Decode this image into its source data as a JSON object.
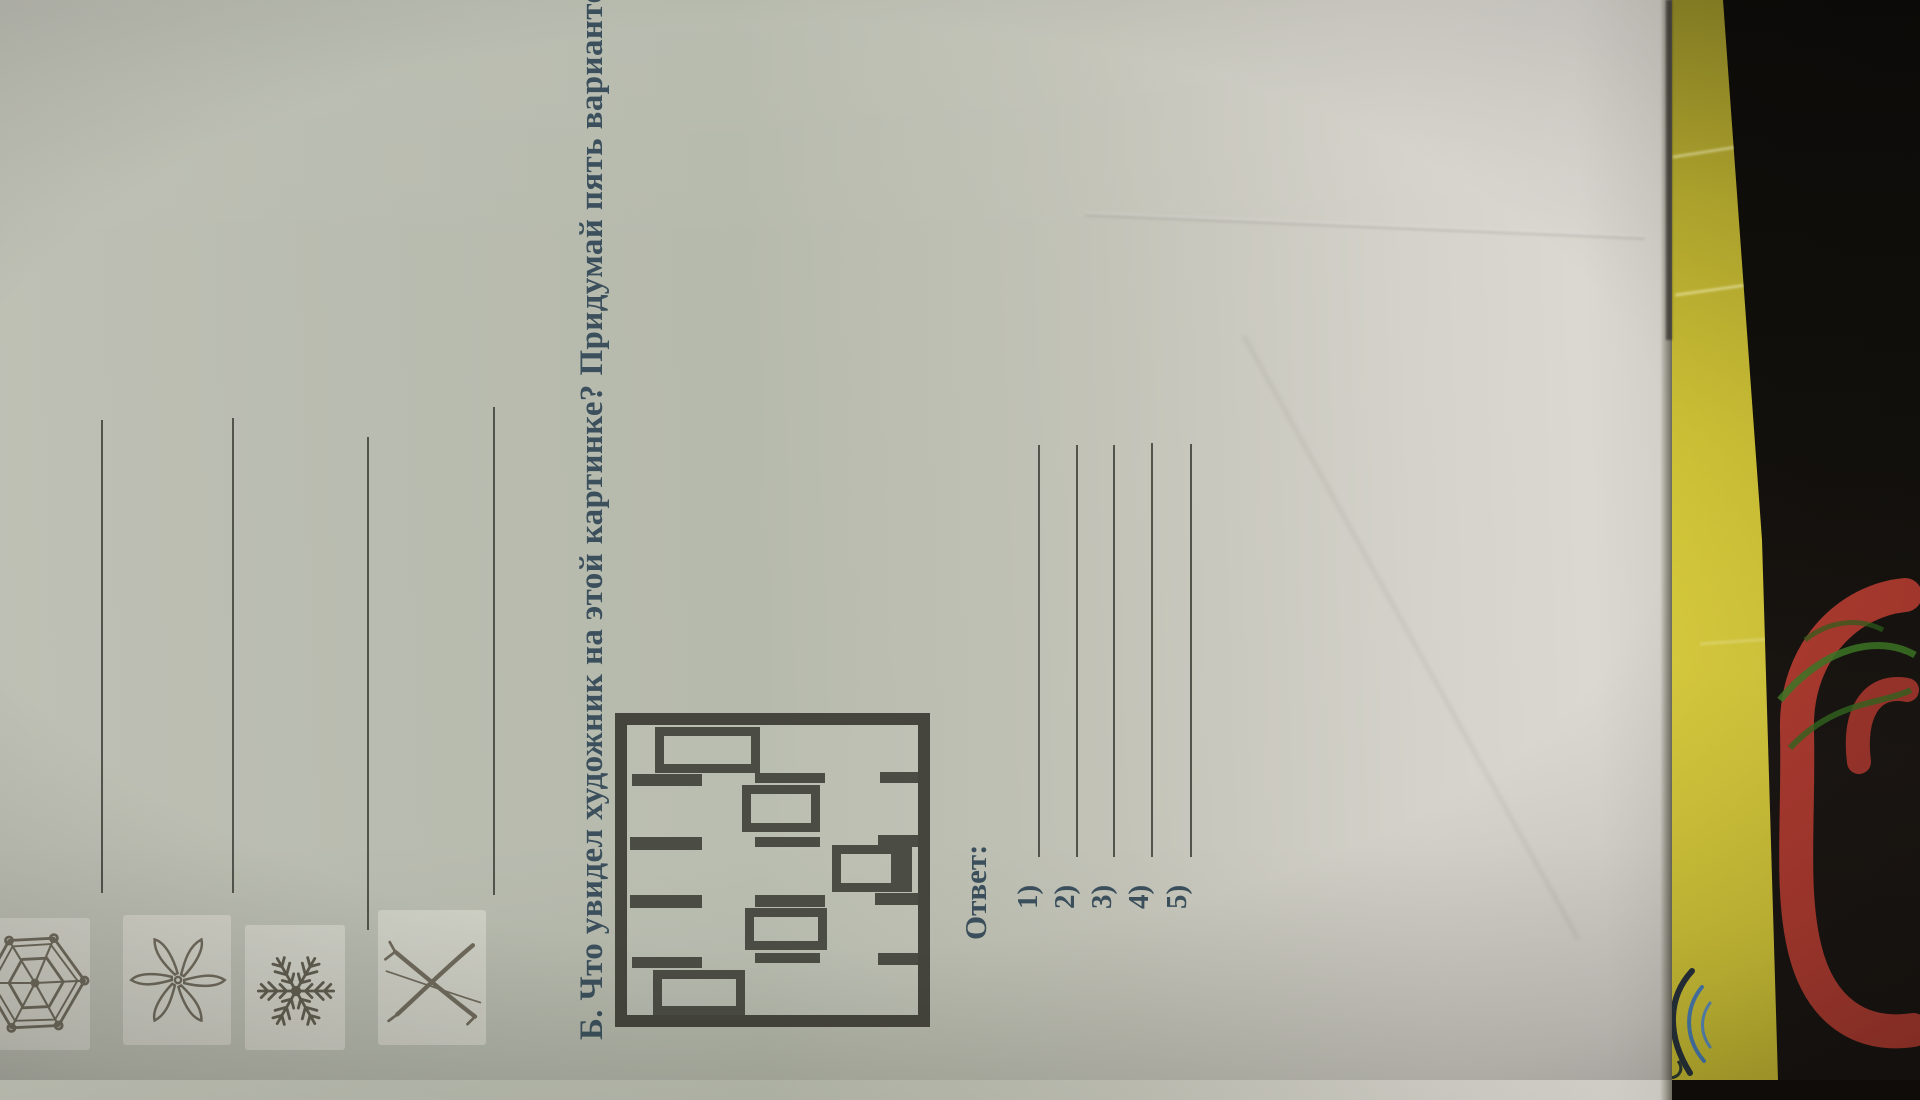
{
  "worksheet": {
    "snowflake_task": {
      "rows": [
        {
          "icon": "hexagon-web-snowflake-icon"
        },
        {
          "icon": "propeller-snowflake-icon"
        },
        {
          "icon": "feathery-snowflake-icon"
        },
        {
          "icon": "crossed-sticks-snowflake-icon"
        }
      ]
    },
    "task_b": {
      "heading": "Б. Что увидел художник на этой картинке? Придумай пять вариантов"
    },
    "picture": {
      "type": "abstract-rectangles-drawing"
    },
    "answers": {
      "label": "Ответ:",
      "items": [
        {
          "label": "1)"
        },
        {
          "label": "2)"
        },
        {
          "label": "3)"
        },
        {
          "label": "4)"
        },
        {
          "label": "5)"
        }
      ]
    }
  },
  "colors": {
    "photo_background": "#0f0c0a",
    "paper": "#b9bcb0",
    "paper_bright": "#dbd8d2",
    "heading_ink": "#3b505c",
    "drawing_ink": "#4b4c43",
    "pencil_gray": "#6e695b",
    "answer_line": "#50544b",
    "folder_yellow": "#d8cb3e",
    "fabric_red": "#b83d33",
    "fabric_green": "#3f7d27"
  }
}
